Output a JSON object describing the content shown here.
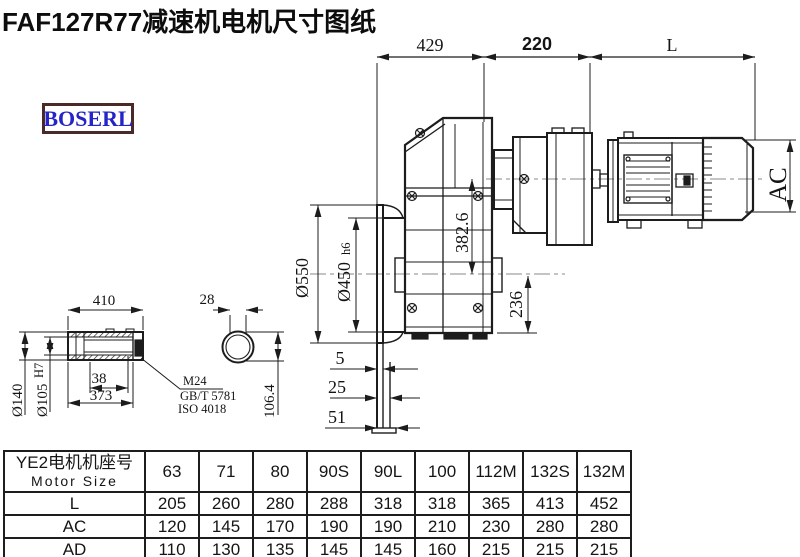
{
  "title": "FAF127R77减速机电机尺寸图纸",
  "logo": "BOSERL",
  "colors": {
    "line": "#1c1c1c",
    "centerline": "#8a8a8a",
    "logo_text": "#2424c8",
    "logo_border": "#4a2a28"
  },
  "main_view": {
    "dims": {
      "top_left": "429",
      "top_mid": "220",
      "top_right": "L",
      "motor_height": "AC",
      "flange_od": "Ø550",
      "spigot_d": "Ø450",
      "spigot_tol": "h6",
      "axis_height": "382.6",
      "bottom_height": "236",
      "offset_a": "5",
      "offset_b": "25",
      "offset_c": "51"
    }
  },
  "shaft_view": {
    "dims": {
      "length": "410",
      "end_width": "28",
      "outer_d": "Ø140",
      "bore_d": "Ø105",
      "bore_tol": "H7",
      "step": "38",
      "usable_len": "373",
      "across": "106.4"
    },
    "callout": {
      "line1": "M24",
      "line2": "GB/T 5781",
      "line3": "ISO 4018"
    }
  },
  "table": {
    "header_cn": "YE2电机机座号",
    "header_en": "Motor Size",
    "columns": [
      "63",
      "71",
      "80",
      "90S",
      "90L",
      "100",
      "112M",
      "132S",
      "132M"
    ],
    "rows": [
      {
        "label": "L",
        "values": [
          "205",
          "260",
          "280",
          "288",
          "318",
          "318",
          "365",
          "413",
          "452"
        ]
      },
      {
        "label": "AC",
        "values": [
          "120",
          "145",
          "170",
          "190",
          "190",
          "210",
          "230",
          "280",
          "280"
        ]
      },
      {
        "label": "AD",
        "values": [
          "110",
          "130",
          "135",
          "145",
          "145",
          "160",
          "215",
          "215",
          "215"
        ]
      }
    ]
  }
}
